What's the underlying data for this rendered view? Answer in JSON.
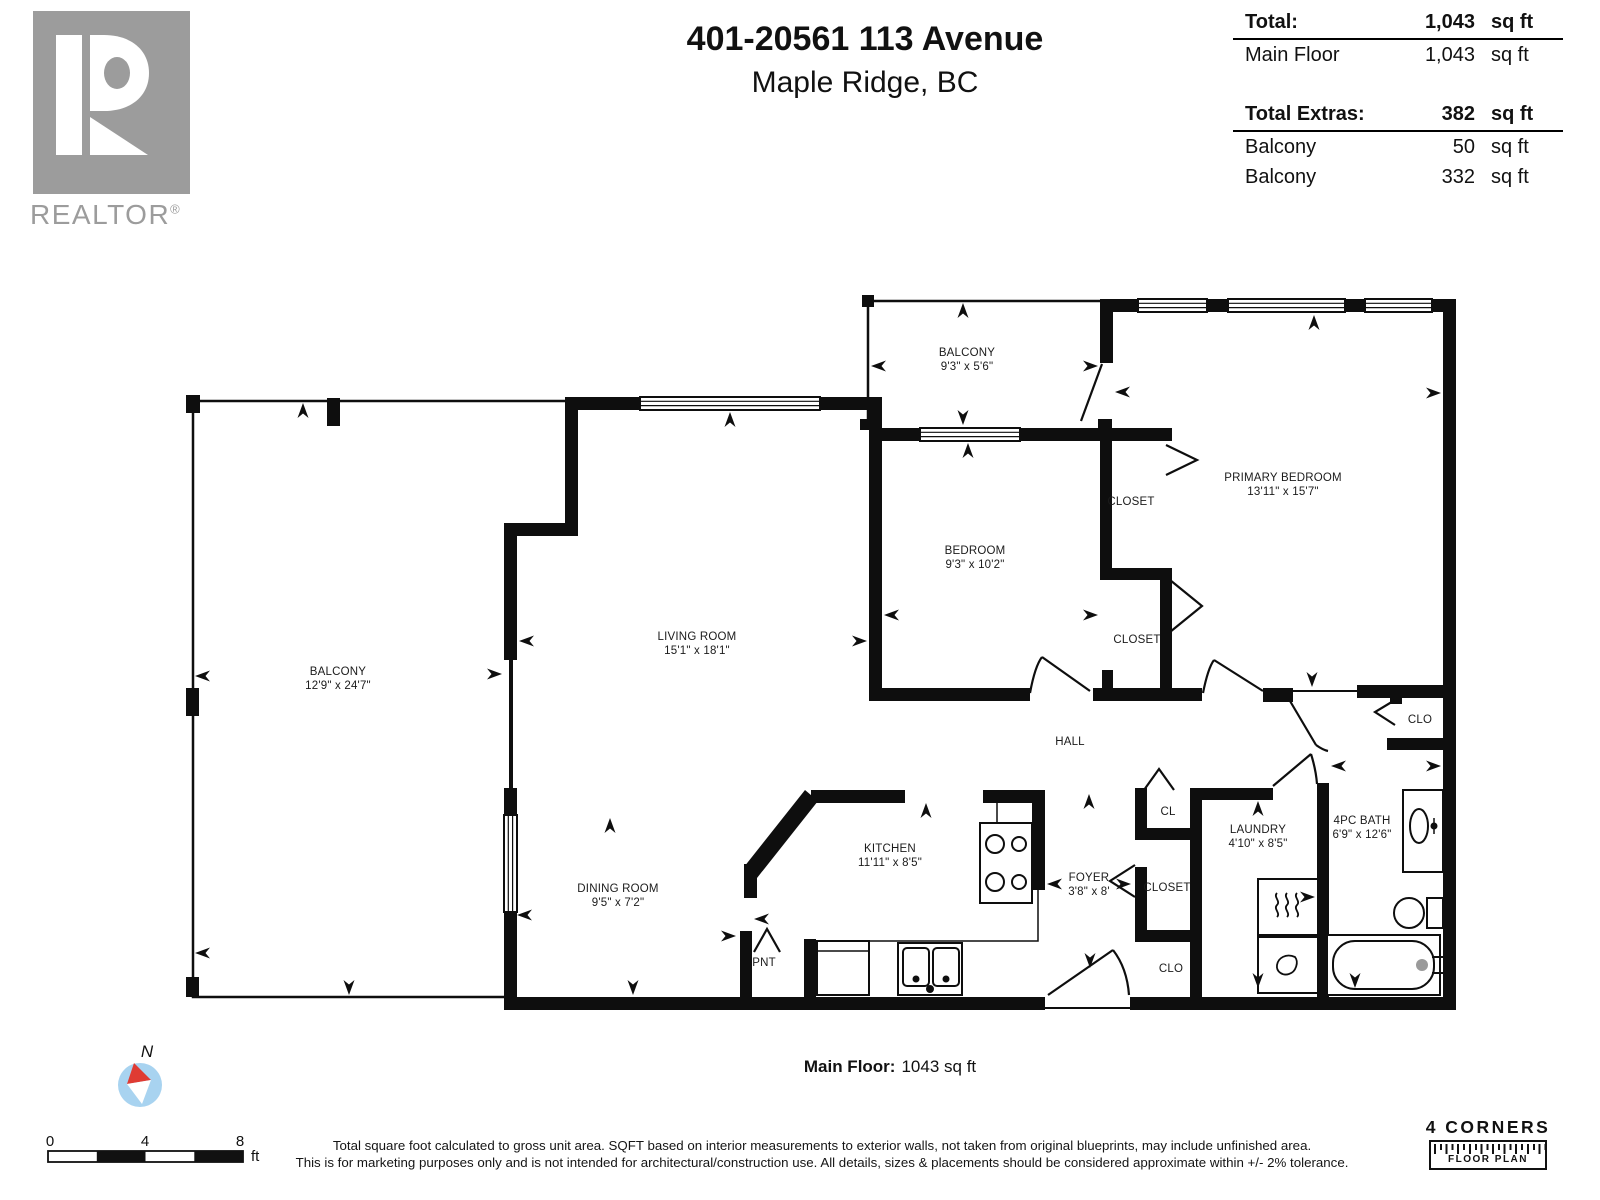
{
  "header": {
    "realtor_label": "REALTOR",
    "realtor_reg": "®",
    "title": "401-20561 113 Avenue",
    "subtitle": "Maple Ridge, BC"
  },
  "stats": {
    "total": {
      "label": "Total:",
      "value": "1,043",
      "unit": "sq ft"
    },
    "main_floor": {
      "label": "Main Floor",
      "value": "1,043",
      "unit": "sq ft"
    },
    "extras_total": {
      "label": "Total Extras:",
      "value": "382",
      "unit": "sq ft"
    },
    "extras": [
      {
        "label": "Balcony",
        "value": "50",
        "unit": "sq ft"
      },
      {
        "label": "Balcony",
        "value": "332",
        "unit": "sq ft"
      }
    ]
  },
  "floorplan": {
    "rooms": [
      {
        "name": "BALCONY",
        "dims": "12'9\" x 24'7\""
      },
      {
        "name": "LIVING ROOM",
        "dims": "15'1\" x 18'1\""
      },
      {
        "name": "BALCONY",
        "dims": "9'3\" x 5'6\""
      },
      {
        "name": "PRIMARY BEDROOM",
        "dims": "13'11\" x 15'7\""
      },
      {
        "name": "BEDROOM",
        "dims": "9'3\" x 10'2\""
      },
      {
        "name": "KITCHEN",
        "dims": "11'11\" x 8'5\""
      },
      {
        "name": "DINING ROOM",
        "dims": "9'5\" x 7'2\""
      },
      {
        "name": "LAUNDRY",
        "dims": "4'10\" x 8'5\""
      },
      {
        "name": "4PC BATH",
        "dims": "6'9\" x 12'6\""
      },
      {
        "name": "FOYER",
        "dims": "3'8\" x 8'"
      }
    ],
    "labels": {
      "closet_top": "CLOSET",
      "closet_mid": "CLOSET",
      "closet_foyer": "CLOSET",
      "hall": "HALL",
      "cl": "CL",
      "clo_right": "CLO",
      "clo_bottom": "CLO",
      "pnt": "PNT"
    },
    "fixtures": [
      "stove",
      "kitchen-sink",
      "dishwasher",
      "washer",
      "dryer",
      "bathroom-sink",
      "toilet",
      "bathtub"
    ],
    "colors": {
      "wall": "#0e0e0e",
      "compass_blue": "#a8d3f0",
      "compass_red": "#df3b33",
      "logo_gray": "#9c9c9c"
    }
  },
  "footer": {
    "caption_label": "Main Floor:",
    "caption_value": "1043 sq ft",
    "compass_n": "N",
    "scale_ticks": [
      "0",
      "4",
      "8"
    ],
    "scale_unit": "ft",
    "disclaimer1": "Total square foot calculated to gross unit area. SQFT based on interior measurements to exterior walls, not taken from original blueprints, may include unfinished area.",
    "disclaimer2": "This is for marketing purposes only and is not intended for architectural/construction use. All details, sizes & placements should be considered approximate within +/- 2% tolerance.",
    "brand_name": "4 CORNERS",
    "brand_sub": "FLOOR PLAN"
  }
}
